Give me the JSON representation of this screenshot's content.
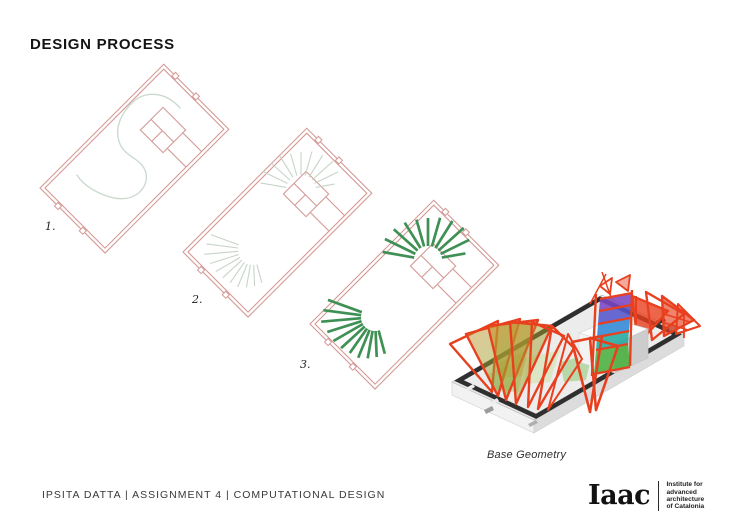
{
  "title": "DESIGN PROCESS",
  "steps": [
    {
      "label": "1.",
      "content": "site plan with attractor S-curve"
    },
    {
      "label": "2.",
      "content": "site plan with light radiating rib lines"
    },
    {
      "label": "3.",
      "content": "site plan with bold green rib members"
    }
  ],
  "render": {
    "caption": "Base Geometry"
  },
  "footer": {
    "credit": "IPSITA DATTA | ASSIGNMENT 4 | COMPUTATIONAL DESIGN"
  },
  "logo": {
    "wordmark": "Iaac",
    "tagline_lines": [
      "Institute for",
      "advanced",
      "architecture",
      "of Catalonia"
    ]
  },
  "colors": {
    "plan_outline": "#d49a96",
    "attractor_curve": "#ccdbcf",
    "ribs_light": "#c7d4c8",
    "ribs_dark": "#3f9054",
    "structure_red": "#e8401f",
    "panel_violet": "#7a45c4",
    "panel_indigo": "#5456cc",
    "panel_blue": "#2f86d4",
    "panel_teal": "#23a89e",
    "panel_green": "#49b13e",
    "base_gray": "#e7e7e7",
    "base_edge_dark": "#2f2f2f"
  }
}
